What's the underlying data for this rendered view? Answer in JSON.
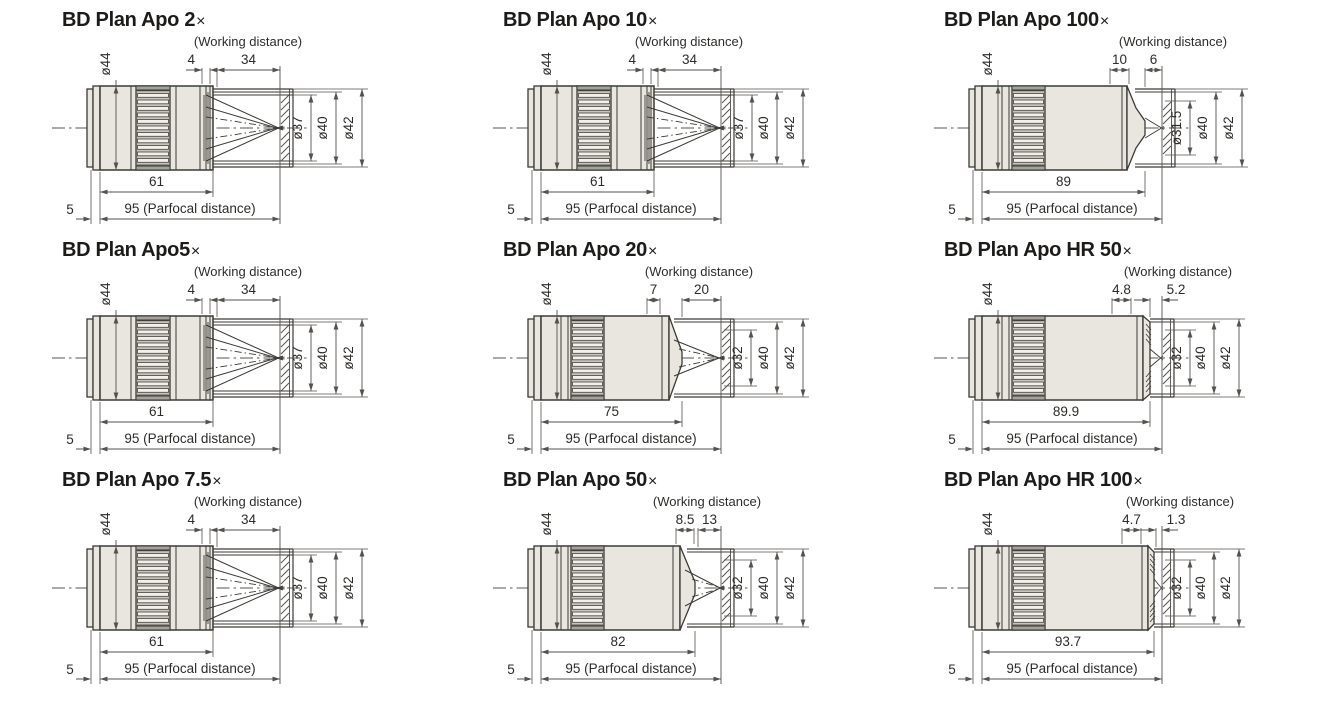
{
  "page": {
    "background": "#ffffff"
  },
  "colors": {
    "outline": "#3c3a36",
    "dim_line": "#55524d",
    "body_fill": "#e9e6df",
    "knurl_base": "#c7c4bd",
    "knurl_slat": "#f2f0ea",
    "centerline": "#8f8d89",
    "text": "#2e2c29",
    "title": "#1c1b19"
  },
  "diagram_grid": {
    "cells": [
      {
        "title": "BD Plan Apo 2",
        "multiplier_sign": "×",
        "working_distance_label": "(Working distance)",
        "dimensions": {
          "pre_working_distance": "4",
          "working_distance": "34",
          "mount_diameter": "ø44",
          "inner_diameter": "ø37",
          "middle_diameter": "ø40",
          "outer_diameter": "ø42",
          "body_length": "61",
          "parfocal": "95 (Parfocal distance)",
          "mount_offset": "5"
        },
        "variant": "cone"
      },
      {
        "title": "BD Plan Apo 10",
        "multiplier_sign": "×",
        "working_distance_label": "(Working distance)",
        "dimensions": {
          "pre_working_distance": "4",
          "working_distance": "34",
          "mount_diameter": "ø44",
          "inner_diameter": "ø37",
          "middle_diameter": "ø40",
          "outer_diameter": "ø42",
          "body_length": "61",
          "parfocal": "95 (Parfocal distance)",
          "mount_offset": "5"
        },
        "variant": "cone"
      },
      {
        "title": "BD Plan Apo 100",
        "multiplier_sign": "×",
        "working_distance_label": "(Working distance)",
        "dimensions": {
          "pre_working_distance": "10",
          "working_distance": "6",
          "mount_diameter": "ø44",
          "inner_diameter": "ø31.5",
          "middle_diameter": "ø40",
          "outer_diameter": "ø42",
          "body_length": "89",
          "parfocal": "95 (Parfocal distance)",
          "mount_offset": "5"
        },
        "variant": "pointed"
      },
      {
        "title": "BD Plan Apo5",
        "multiplier_sign": "×",
        "working_distance_label": "(Working distance)",
        "dimensions": {
          "pre_working_distance": "4",
          "working_distance": "34",
          "mount_diameter": "ø44",
          "inner_diameter": "ø37",
          "middle_diameter": "ø40",
          "outer_diameter": "ø42",
          "body_length": "61",
          "parfocal": "95 (Parfocal distance)",
          "mount_offset": "5"
        },
        "variant": "cone"
      },
      {
        "title": "BD Plan Apo 20",
        "multiplier_sign": "×",
        "working_distance_label": "(Working distance)",
        "dimensions": {
          "pre_working_distance": "7",
          "working_distance": "20",
          "mount_diameter": "ø44",
          "inner_diameter": "ø32",
          "middle_diameter": "ø40",
          "outer_diameter": "ø42",
          "body_length": "75",
          "parfocal": "95 (Parfocal distance)",
          "mount_offset": "5"
        },
        "variant": "taper"
      },
      {
        "title": "BD Plan Apo HR 50",
        "multiplier_sign": "×",
        "working_distance_label": "(Working distance)",
        "dimensions": {
          "pre_working_distance": "4.8",
          "working_distance": "5.2",
          "mount_diameter": "ø44",
          "inner_diameter": "ø32",
          "middle_diameter": "ø40",
          "outer_diameter": "ø42",
          "body_length": "89.9",
          "parfocal": "95 (Parfocal distance)",
          "mount_offset": "5"
        },
        "variant": "flat"
      },
      {
        "title": "BD Plan Apo 7.5",
        "multiplier_sign": "×",
        "working_distance_label": "(Working distance)",
        "dimensions": {
          "pre_working_distance": "4",
          "working_distance": "34",
          "mount_diameter": "ø44",
          "inner_diameter": "ø37",
          "middle_diameter": "ø40",
          "outer_diameter": "ø42",
          "body_length": "61",
          "parfocal": "95 (Parfocal distance)",
          "mount_offset": "5"
        },
        "variant": "cone"
      },
      {
        "title": "BD Plan Apo 50",
        "multiplier_sign": "×",
        "working_distance_label": "(Working distance)",
        "dimensions": {
          "pre_working_distance": "8.5",
          "working_distance": "13",
          "mount_diameter": "ø44",
          "inner_diameter": "ø32",
          "middle_diameter": "ø40",
          "outer_diameter": "ø42",
          "body_length": "82",
          "parfocal": "95 (Parfocal distance)",
          "mount_offset": "5"
        },
        "variant": "taper"
      },
      {
        "title": "BD Plan Apo HR 100",
        "multiplier_sign": "×",
        "working_distance_label": "(Working distance)",
        "dimensions": {
          "pre_working_distance": "4.7",
          "working_distance": "1.3",
          "mount_diameter": "ø44",
          "inner_diameter": "ø32",
          "middle_diameter": "ø40",
          "outer_diameter": "ø42",
          "body_length": "93.7",
          "parfocal": "95 (Parfocal distance)",
          "mount_offset": "5"
        },
        "variant": "flat"
      }
    ]
  }
}
